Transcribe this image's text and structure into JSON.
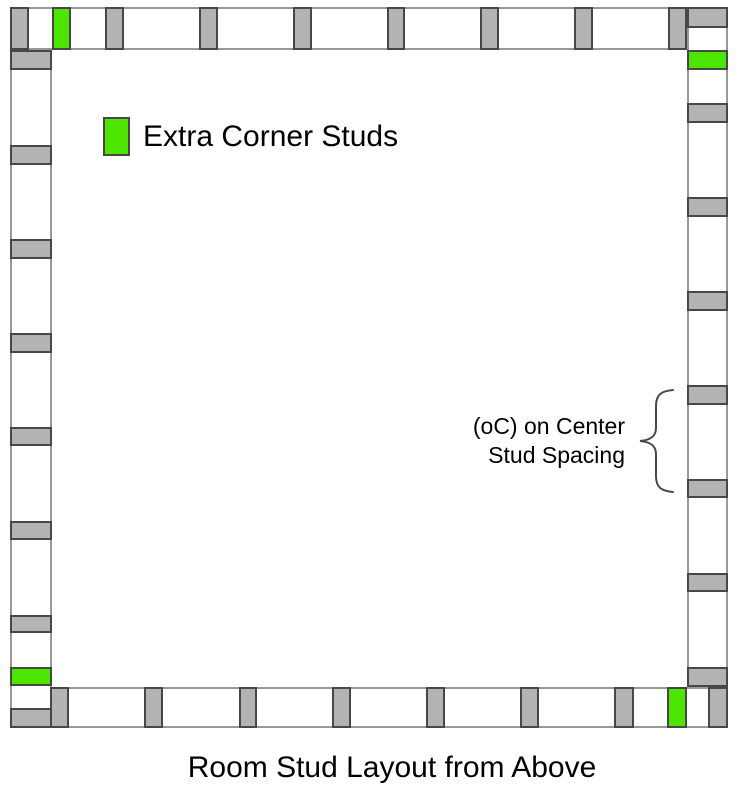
{
  "colors": {
    "wall_fill": "#ffffff",
    "wall_border": "#999999",
    "stud_fill": "#b3b3b3",
    "stud_border": "#474747",
    "extra_stud_fill": "#4de600",
    "text": "#000000"
  },
  "legend": {
    "label": "Extra Corner Studs"
  },
  "annotation": {
    "line1": "(oC) on Center",
    "line2": "Stud Spacing"
  },
  "caption": {
    "text": "Room Stud Layout from Above"
  },
  "diagram": {
    "walls": [
      {
        "name": "top",
        "x": 10,
        "y": 7,
        "w": 677,
        "h": 43
      },
      {
        "name": "right",
        "x": 687,
        "y": 7,
        "w": 41,
        "h": 680
      },
      {
        "name": "bottom",
        "x": 50,
        "y": 687,
        "w": 678,
        "h": 41
      },
      {
        "name": "left",
        "x": 10,
        "y": 50,
        "w": 42,
        "h": 678
      }
    ],
    "studs": [
      {
        "id": "top-corner",
        "x": 10,
        "y": 7,
        "w": 19,
        "h": 43,
        "color": "gray"
      },
      {
        "id": "top-extra",
        "x": 52,
        "y": 7,
        "w": 19,
        "h": 43,
        "color": "green"
      },
      {
        "id": "top-2",
        "x": 105,
        "y": 7,
        "w": 19,
        "h": 43,
        "color": "gray"
      },
      {
        "id": "top-3",
        "x": 199,
        "y": 7,
        "w": 19,
        "h": 43,
        "color": "gray"
      },
      {
        "id": "top-4",
        "x": 293,
        "y": 7,
        "w": 19,
        "h": 43,
        "color": "gray"
      },
      {
        "id": "top-5",
        "x": 387,
        "y": 7,
        "w": 18,
        "h": 43,
        "color": "gray"
      },
      {
        "id": "top-6",
        "x": 480,
        "y": 7,
        "w": 19,
        "h": 43,
        "color": "gray"
      },
      {
        "id": "top-7",
        "x": 574,
        "y": 7,
        "w": 19,
        "h": 43,
        "color": "gray"
      },
      {
        "id": "top-8",
        "x": 668,
        "y": 7,
        "w": 19,
        "h": 43,
        "color": "gray"
      },
      {
        "id": "right-corner",
        "x": 687,
        "y": 7,
        "w": 41,
        "h": 21,
        "color": "gray"
      },
      {
        "id": "right-extra",
        "x": 687,
        "y": 50,
        "w": 41,
        "h": 20,
        "color": "green"
      },
      {
        "id": "right-2",
        "x": 687,
        "y": 103,
        "w": 41,
        "h": 20,
        "color": "gray"
      },
      {
        "id": "right-3",
        "x": 687,
        "y": 197,
        "w": 41,
        "h": 20,
        "color": "gray"
      },
      {
        "id": "right-4",
        "x": 687,
        "y": 291,
        "w": 41,
        "h": 20,
        "color": "gray"
      },
      {
        "id": "right-5",
        "x": 687,
        "y": 385,
        "w": 41,
        "h": 20,
        "color": "gray"
      },
      {
        "id": "right-6",
        "x": 687,
        "y": 479,
        "w": 41,
        "h": 19,
        "color": "gray"
      },
      {
        "id": "right-7",
        "x": 687,
        "y": 573,
        "w": 41,
        "h": 19,
        "color": "gray"
      },
      {
        "id": "right-8",
        "x": 687,
        "y": 667,
        "w": 41,
        "h": 20,
        "color": "gray"
      },
      {
        "id": "bottom-1",
        "x": 50,
        "y": 687,
        "w": 19,
        "h": 41,
        "color": "gray"
      },
      {
        "id": "bottom-2",
        "x": 144,
        "y": 687,
        "w": 19,
        "h": 41,
        "color": "gray"
      },
      {
        "id": "bottom-3",
        "x": 239,
        "y": 687,
        "w": 18,
        "h": 41,
        "color": "gray"
      },
      {
        "id": "bottom-4",
        "x": 332,
        "y": 687,
        "w": 19,
        "h": 41,
        "color": "gray"
      },
      {
        "id": "bottom-5",
        "x": 426,
        "y": 687,
        "w": 19,
        "h": 41,
        "color": "gray"
      },
      {
        "id": "bottom-6",
        "x": 520,
        "y": 687,
        "w": 19,
        "h": 41,
        "color": "gray"
      },
      {
        "id": "bottom-7",
        "x": 614,
        "y": 687,
        "w": 20,
        "h": 41,
        "color": "gray"
      },
      {
        "id": "bottom-extra",
        "x": 667,
        "y": 687,
        "w": 20,
        "h": 41,
        "color": "green"
      },
      {
        "id": "bottom-corner",
        "x": 708,
        "y": 687,
        "w": 20,
        "h": 41,
        "color": "gray"
      },
      {
        "id": "left-1",
        "x": 10,
        "y": 50,
        "w": 42,
        "h": 20,
        "color": "gray"
      },
      {
        "id": "left-2",
        "x": 10,
        "y": 145,
        "w": 42,
        "h": 20,
        "color": "gray"
      },
      {
        "id": "left-3",
        "x": 10,
        "y": 239,
        "w": 42,
        "h": 20,
        "color": "gray"
      },
      {
        "id": "left-4",
        "x": 10,
        "y": 333,
        "w": 42,
        "h": 20,
        "color": "gray"
      },
      {
        "id": "left-5",
        "x": 10,
        "y": 427,
        "w": 42,
        "h": 19,
        "color": "gray"
      },
      {
        "id": "left-6",
        "x": 10,
        "y": 521,
        "w": 42,
        "h": 19,
        "color": "gray"
      },
      {
        "id": "left-7",
        "x": 10,
        "y": 615,
        "w": 42,
        "h": 18,
        "color": "gray"
      },
      {
        "id": "left-extra",
        "x": 10,
        "y": 667,
        "w": 42,
        "h": 19,
        "color": "green"
      },
      {
        "id": "left-corner",
        "x": 10,
        "y": 708,
        "w": 42,
        "h": 20,
        "color": "gray"
      }
    ]
  }
}
